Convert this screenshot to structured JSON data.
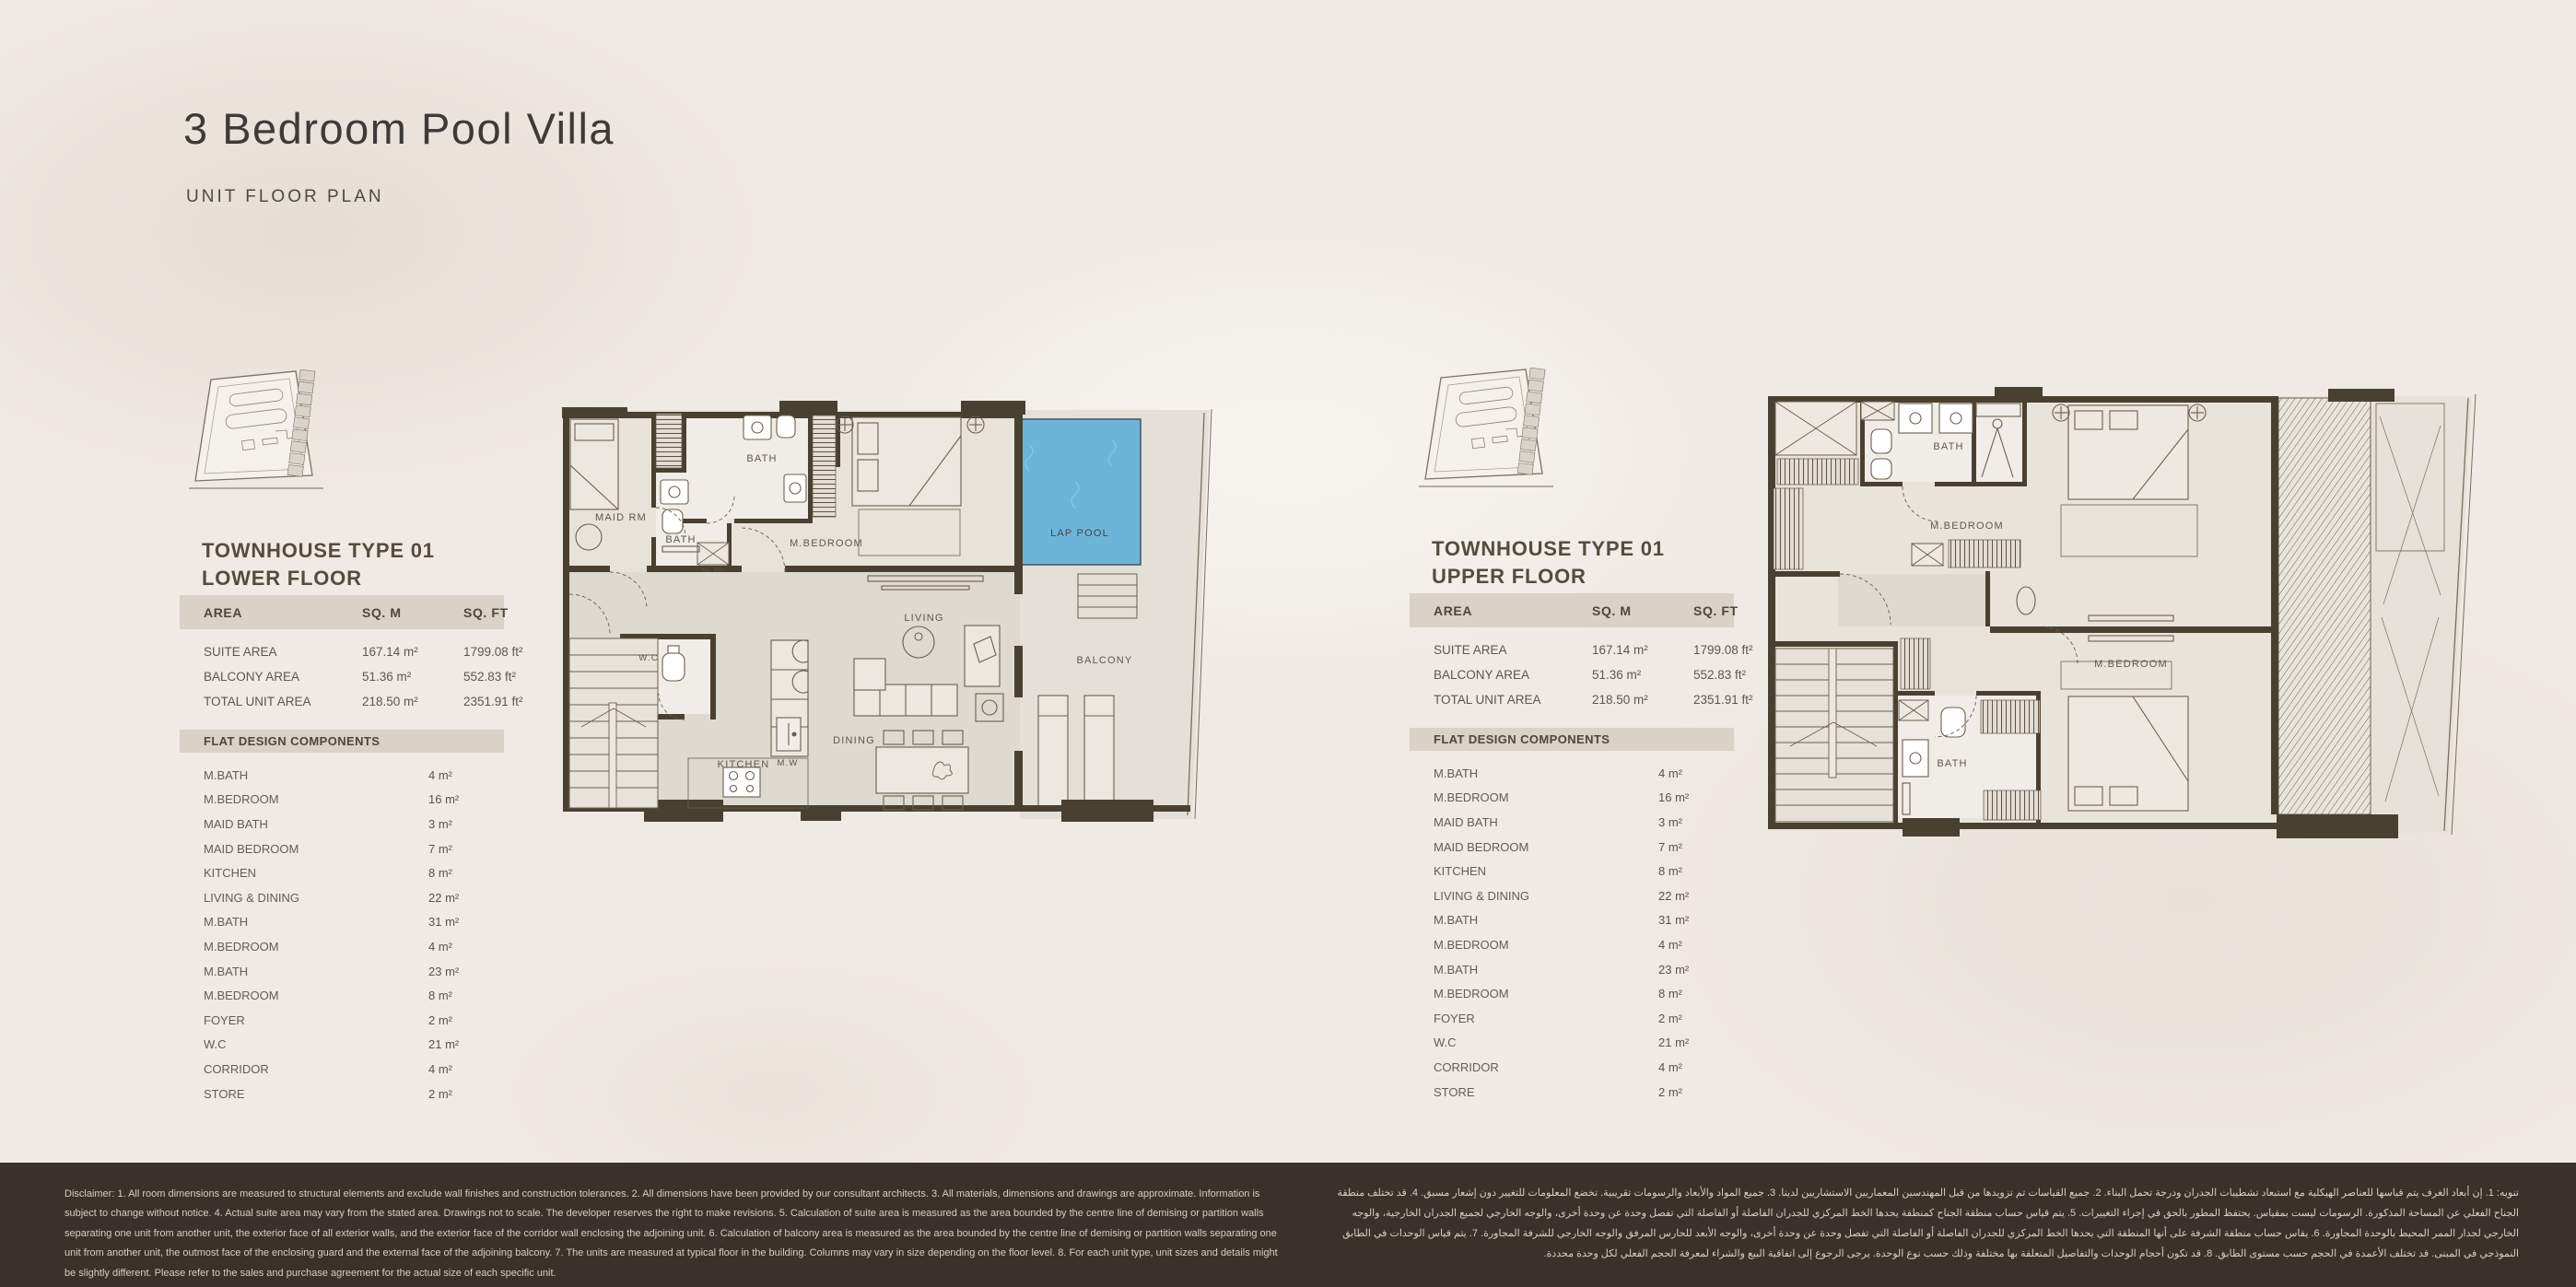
{
  "page": {
    "title": "3 Bedroom Pool Villa",
    "subtitle": "UNIT FLOOR PLAN"
  },
  "colors": {
    "background": "#efeae3",
    "wall_brown": "#4a4031",
    "band_beige": "#d8d2c7",
    "pool_blue": "#6db5d8",
    "footer_brown": "#39322a",
    "heading_text": "#544c3d"
  },
  "panels": [
    {
      "heading_line1": "TOWNHOUSE TYPE 01",
      "heading_line2": "LOWER FLOOR",
      "area_table": {
        "headers": [
          "AREA",
          "SQ. M",
          "SQ. FT"
        ],
        "rows": [
          {
            "label": "SUITE AREA",
            "sqm": "167.14 m²",
            "sqft": "1799.08 ft²"
          },
          {
            "label": "BALCONY AREA",
            "sqm": "51.36 m²",
            "sqft": "552.83 ft²"
          },
          {
            "label": "TOTAL UNIT AREA",
            "sqm": "218.50 m²",
            "sqft": "2351.91 ft²"
          }
        ]
      },
      "components_header": "FLAT DESIGN COMPONENTS",
      "components": [
        {
          "label": "M.BATH",
          "value": "4 m²"
        },
        {
          "label": "M.BEDROOM",
          "value": "16 m²"
        },
        {
          "label": "MAID BATH",
          "value": "3 m²"
        },
        {
          "label": "MAID BEDROOM",
          "value": "7 m²"
        },
        {
          "label": "KITCHEN",
          "value": "8 m²"
        },
        {
          "label": "LIVING & DINING",
          "value": "22 m²"
        },
        {
          "label": "M.BATH",
          "value": "31 m²"
        },
        {
          "label": "M.BEDROOM",
          "value": "4 m²"
        },
        {
          "label": "M.BATH",
          "value": "23 m²"
        },
        {
          "label": "M.BEDROOM",
          "value": "8 m²"
        },
        {
          "label": "FOYER",
          "value": "2 m²"
        },
        {
          "label": "W.C",
          "value": "21 m²"
        },
        {
          "label": "CORRIDOR",
          "value": "4 m²"
        },
        {
          "label": "STORE",
          "value": "2 m²"
        }
      ]
    },
    {
      "heading_line1": "TOWNHOUSE TYPE 01",
      "heading_line2": "UPPER FLOOR",
      "area_table": {
        "headers": [
          "AREA",
          "SQ. M",
          "SQ. FT"
        ],
        "rows": [
          {
            "label": "SUITE AREA",
            "sqm": "167.14 m²",
            "sqft": "1799.08 ft²"
          },
          {
            "label": "BALCONY AREA",
            "sqm": "51.36 m²",
            "sqft": "552.83 ft²"
          },
          {
            "label": "TOTAL UNIT AREA",
            "sqm": "218.50 m²",
            "sqft": "2351.91 ft²"
          }
        ]
      },
      "components_header": "FLAT DESIGN COMPONENTS",
      "components": [
        {
          "label": "M.BATH",
          "value": "4 m²"
        },
        {
          "label": "M.BEDROOM",
          "value": "16 m²"
        },
        {
          "label": "MAID BATH",
          "value": "3 m²"
        },
        {
          "label": "MAID BEDROOM",
          "value": "7 m²"
        },
        {
          "label": "KITCHEN",
          "value": "8 m²"
        },
        {
          "label": "LIVING & DINING",
          "value": "22 m²"
        },
        {
          "label": "M.BATH",
          "value": "31 m²"
        },
        {
          "label": "M.BEDROOM",
          "value": "4 m²"
        },
        {
          "label": "M.BATH",
          "value": "23 m²"
        },
        {
          "label": "M.BEDROOM",
          "value": "8 m²"
        },
        {
          "label": "FOYER",
          "value": "2 m²"
        },
        {
          "label": "W.C",
          "value": "21 m²"
        },
        {
          "label": "CORRIDOR",
          "value": "4 m²"
        },
        {
          "label": "STORE",
          "value": "2 m²"
        }
      ]
    }
  ],
  "floorplans": {
    "lower": {
      "labels": {
        "maid_rm": "MAID RM",
        "bath_maid": "BATH",
        "bath_top": "BATH",
        "mbedroom": "M.BEDROOM",
        "tel_box": "TEL. BOX",
        "lap_pool": "LAP POOL",
        "living": "LIVING",
        "balcony": "BALCONY",
        "wc": "W.C",
        "kitchen": "KITCHEN",
        "mw": "M.W",
        "dining": "DINING"
      }
    },
    "upper": {
      "labels": {
        "bath_top": "BATH",
        "mbedroom_top": "M.BEDROOM",
        "mbedroom_bottom": "M.BEDROOM",
        "bath_bottom": "BATH"
      }
    }
  },
  "footer": {
    "disclaimer_en": "Disclaimer: 1. All room dimensions are measured to structural elements and exclude wall finishes and construction tolerances. 2. All dimensions have been provided by our consultant architects. 3. All materials, dimensions and drawings are approximate. Information is subject to change without notice. 4. Actual suite area may vary from the stated area. Drawings not to scale. The developer reserves the right to make revisions. 5. Calculation of suite area is measured as the area bounded by the centre line of demising or partition walls separating one unit from another unit, the exterior face of all exterior walls, and the exterior face of the corridor wall enclosing the adjoining unit. 6. Calculation of balcony area is measured as the area bounded by the centre line of demising or partition walls separating one unit from another unit, the outmost face of the enclosing guard and the external face of the adjoining balcony. 7. The units are measured at typical floor in the building. Columns may vary in size depending on the floor level. 8. For each unit type, unit sizes and details might be slightly different. Please refer to the sales and purchase agreement for the actual size of each specific unit.",
    "disclaimer_ar": "تنويه: 1. إن أبعاد الغرف يتم قياسها للعناصر الهيكلية مع استبعاد تشطيبات الجدران ودرجة تحمل البناء. 2. جميع القياسات تم تزويدها من قبل المهندسين المعماريين الاستشاريين لدينا. 3. جميع المواد والأبعاد والرسومات تقريبية. تخضع المعلومات للتغيير دون إشعار مسبق. 4. قد تختلف منطقة الجناح الفعلي عن المساحة المذكورة. الرسومات ليست بمقياس. يحتفظ المطور بالحق في إجراء التغييرات. 5. يتم قياس حساب منطقة الجناح كمنطقة يحدها الخط المركزي للجدران الفاصلة أو الفاصلة التي تفصل وحدة عن وحدة أخرى، والوجه الخارجي لجميع الجدران الخارجية، والوجه الخارجي لجدار الممر المحيط بالوحدة المجاورة. 6. يقاس حساب منطقة الشرفة على أنها المنطقة التي يحدها الخط المركزي للجدران الفاصلة أو الفاصلة التي تفصل وحدة عن وحدة أخرى، والوجه الأبعد للحارس المرفق والوجه الخارجي للشرفة المجاورة. 7. يتم قياس الوحدات في الطابق النموذجي في المبنى. قد تختلف الأعمدة في الحجم حسب مستوى الطابق. 8. قد تكون أحجام الوحدات والتفاصيل المتعلقة بها مختلفة وذلك حسب نوع الوحدة. يرجى الرجوع إلى اتفاقية البيع والشراء لمعرفة الحجم الفعلي لكل وحدة محددة."
  }
}
